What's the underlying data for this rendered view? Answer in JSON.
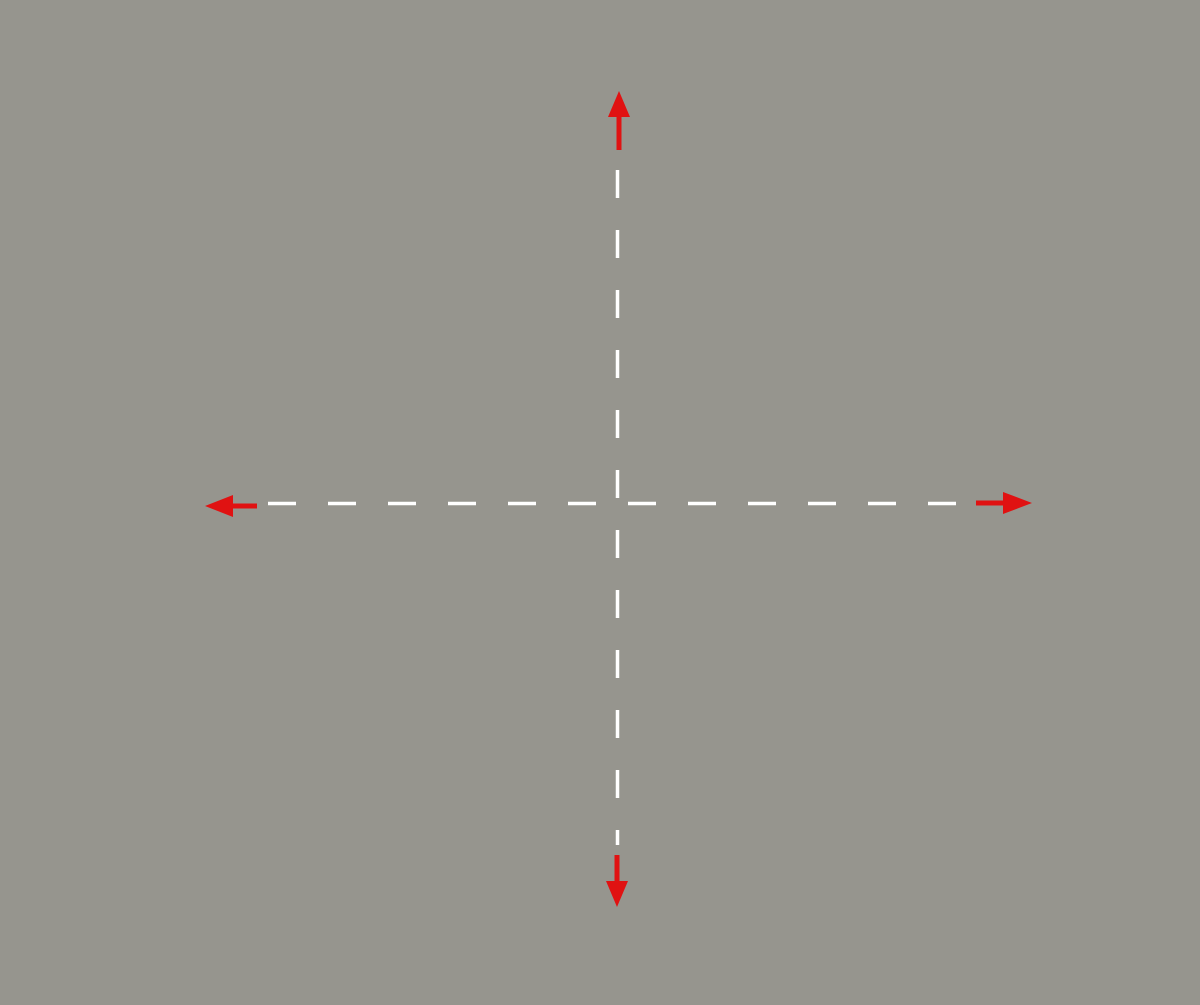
{
  "map_overlay": {
    "compass": {
      "north": "N",
      "west": "O",
      "east": "E",
      "south": "S"
    },
    "watermark": "2020 Inst",
    "colors": {
      "hatch_blue": "#2b2bc4",
      "outline_blue": "#2020bb",
      "arrow_red": "#e01212",
      "crosshair_white": "#ffffff"
    },
    "semicircle": {
      "center_x": 617,
      "center_y": 503.5,
      "radius": 330,
      "half": "lower",
      "hatch_angle_deg": 35,
      "hatch_spacing_px": 9.5
    }
  }
}
